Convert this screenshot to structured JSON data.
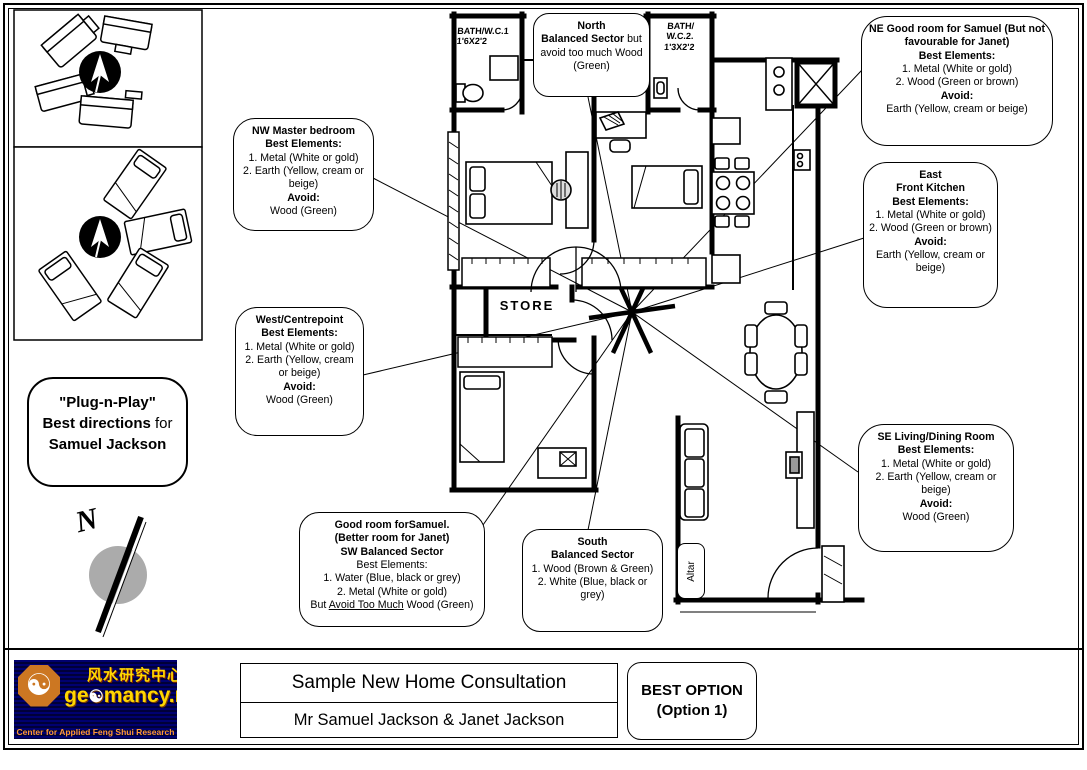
{
  "page": {
    "background": "#ffffff",
    "line_color": "#000000",
    "compass_fill": "#ababab"
  },
  "plug_bubble": {
    "line1": "\"Plug-n-Play\"",
    "line2_bold": "Best directions",
    "line2_rest": " for",
    "line3": "Samuel Jackson"
  },
  "compass": {
    "north_label": "N"
  },
  "plan_labels": {
    "bath1_line1": "BATH/W.C.1",
    "bath1_line2": "1'6X2'2",
    "bath2_line1": "BATH/",
    "bath2_line2": "W.C.2.",
    "bath2_line3": "1'3X2'2",
    "store": "STORE",
    "altar": "Altar"
  },
  "callouts": {
    "north": {
      "title": "North",
      "bold": "Balanced Sector",
      "rest": " but avoid too much Wood (Green)"
    },
    "ne": {
      "title": "NE Good room for Samuel (But not favourable for Janet)",
      "best_label": "Best Elements:",
      "item1": "1. Metal (White or gold)",
      "item2": "2. Wood (Green or brown)",
      "avoid_label": "Avoid:",
      "avoid_value": "Earth (Yellow, cream or beige)"
    },
    "nw": {
      "title": "NW Master bedroom",
      "best_label": "Best Elements:",
      "item1": "1. Metal (White or gold)",
      "item2": "2. Earth (Yellow, cream or beige)",
      "avoid_label": "Avoid:",
      "avoid_value": "Wood (Green)"
    },
    "east": {
      "title1": "East",
      "title2": "Front Kitchen",
      "best_label": "Best Elements:",
      "item1": "1. Metal (White or gold)",
      "item2": "2. Wood (Green or brown)",
      "avoid_label": "Avoid:",
      "avoid_value": "Earth (Yellow, cream or beige)"
    },
    "west": {
      "title": "West/Centrepoint",
      "best_label": "Best Elements:",
      "item1": "1. Metal (White or gold)",
      "item2": "2. Earth (Yellow, cream or beige)",
      "avoid_label": "Avoid:",
      "avoid_value": "Wood (Green)"
    },
    "se": {
      "title": "SE Living/Dining Room",
      "best_label": "Best Elements:",
      "item1": "1. Metal (White or gold)",
      "item2": "2. Earth (Yellow, cream or beige)",
      "avoid_label": "Avoid:",
      "avoid_value": "Wood (Green)"
    },
    "sw": {
      "title1": "Good room forSamuel.",
      "title2": "(Better room for Janet)",
      "title3": "SW Balanced Sector",
      "best_label": "Best Elements:",
      "item1": "1. Water (Blue, black or grey)",
      "item2": "2. Metal (White or gold)",
      "last_pre": "But ",
      "last_underline": "Avoid Too Much",
      "last_post": " Wood (Green)"
    },
    "south": {
      "title1": "South",
      "title2": "Balanced Sector",
      "item1": "1. Wood (Brown & Green)",
      "item2": "2. White (Blue, black or grey)"
    }
  },
  "footer": {
    "logo": {
      "icon": "yinyang-bagua-icon",
      "icon_glyph": "☯",
      "brand_left": "ge",
      "brand_right": "mancy.net",
      "chinese": "风水研究中心",
      "tagline": "Center for Applied Feng Shui Research",
      "background": "#000066",
      "text_color": "#ffd700",
      "tagline_color": "#ff9933"
    },
    "project_title": "Sample New Home Consultation",
    "client_line": "Mr Samuel Jackson & Janet Jackson",
    "best_option_line1": "BEST OPTION",
    "best_option_line2": "(Option 1)"
  }
}
